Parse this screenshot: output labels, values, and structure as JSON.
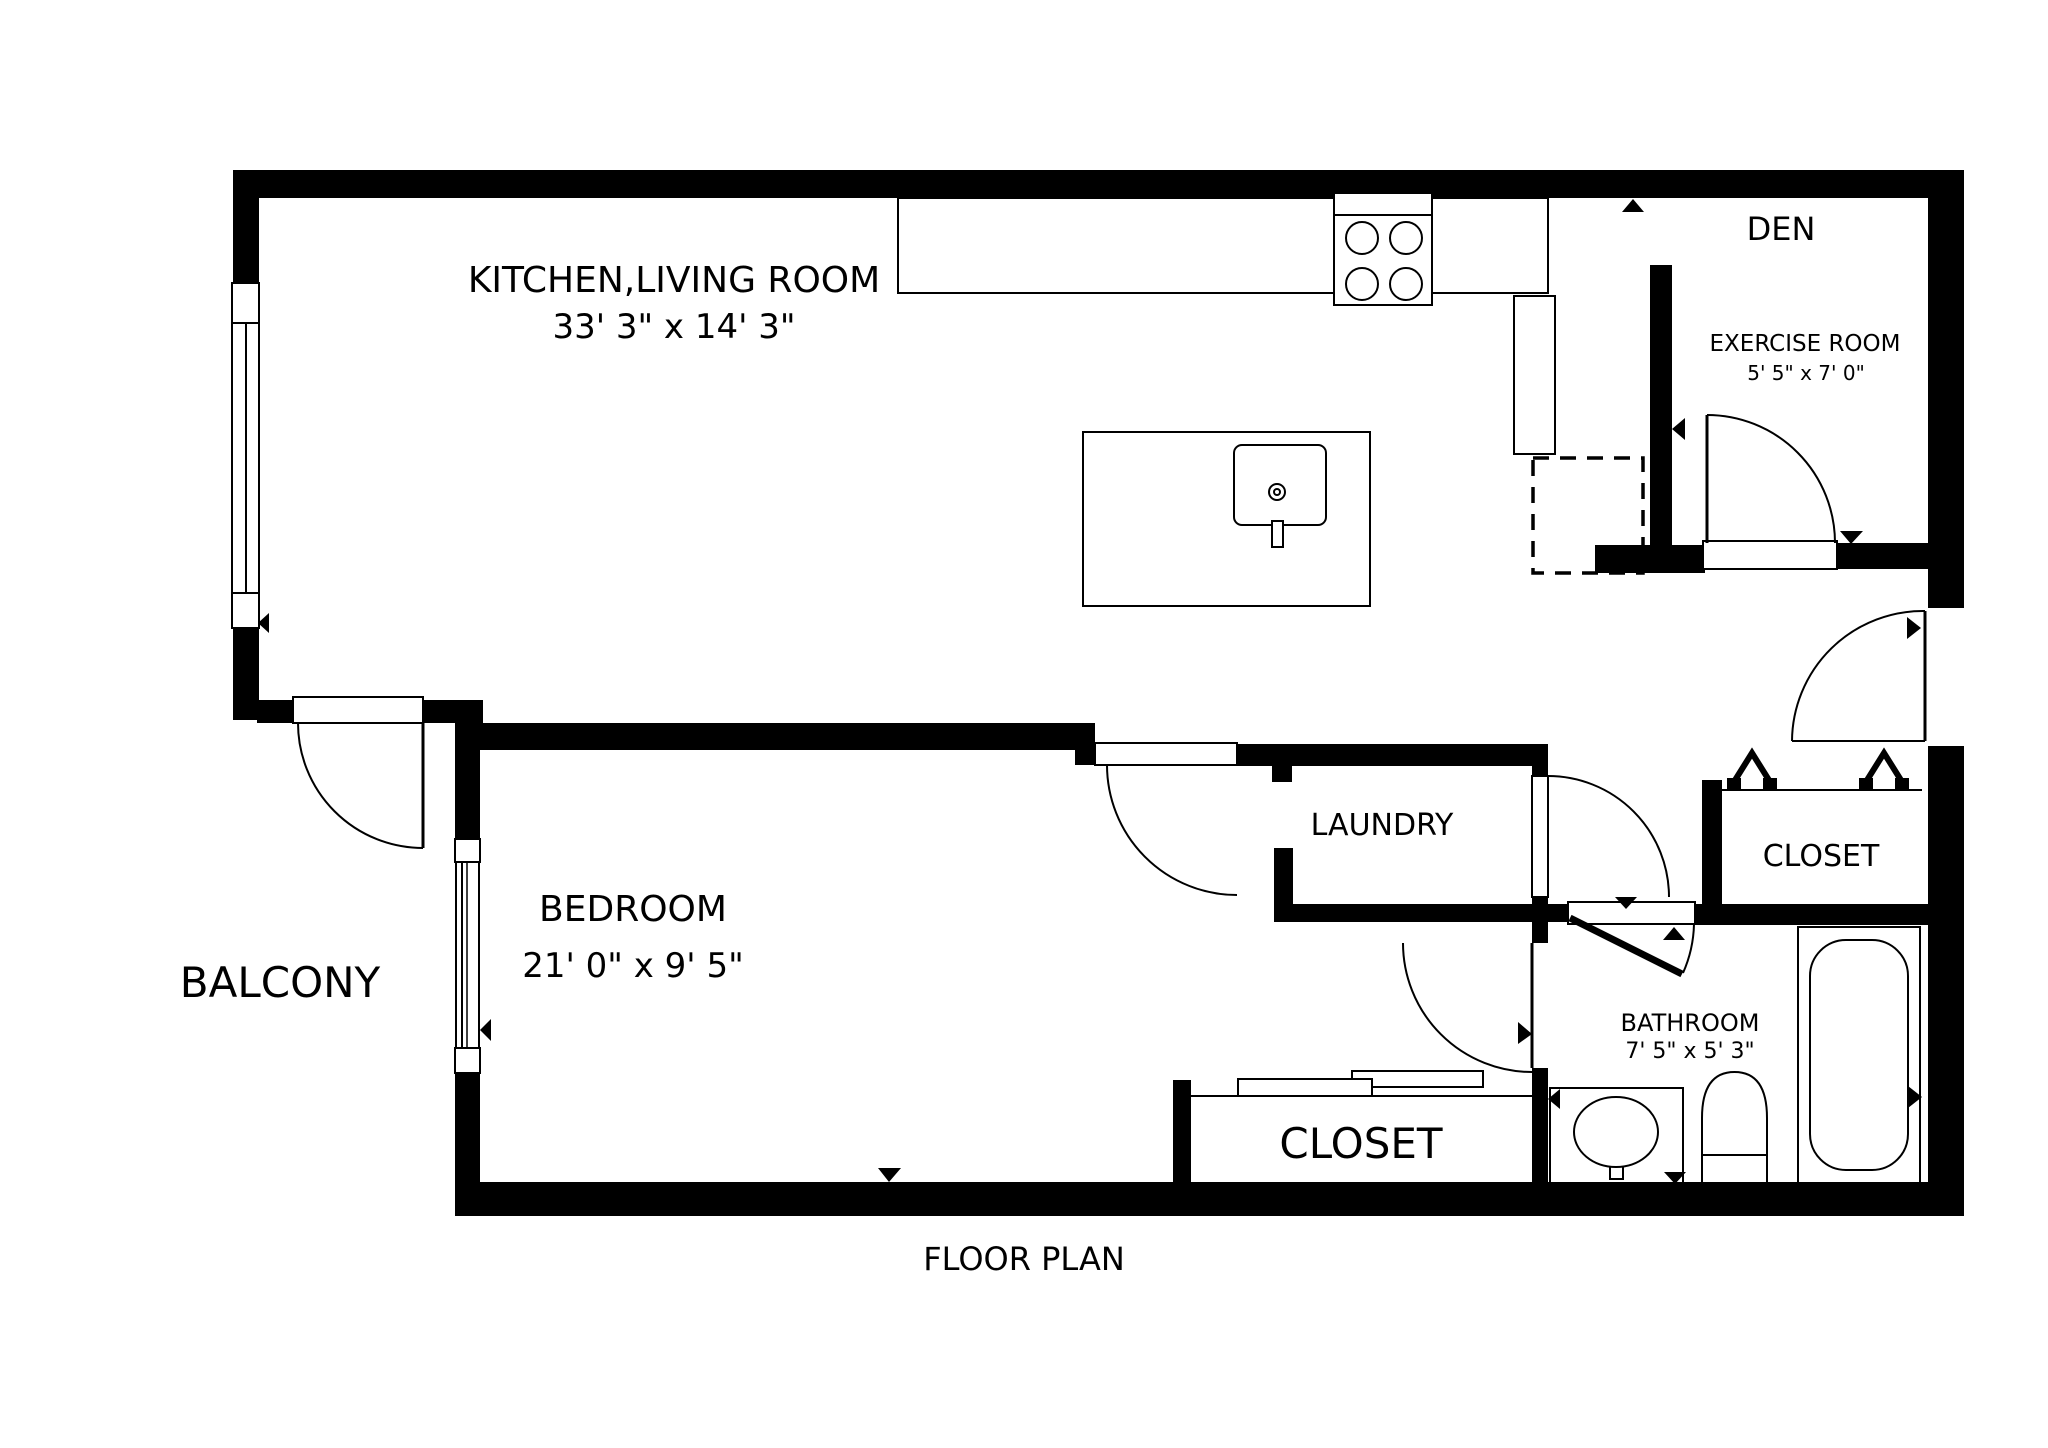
{
  "canvas": {
    "w": 2048,
    "h": 1448,
    "bg": "#ffffff",
    "ink": "#000000"
  },
  "caption": {
    "text": "FLOOR PLAN",
    "x": 1024,
    "y": 1270,
    "size": 32
  },
  "rooms": [
    {
      "id": "kitchen-living",
      "label": "KITCHEN,LIVING ROOM",
      "dims": "33' 3\" x 14' 3\"",
      "lx": 674,
      "ly": 292,
      "ls": 36,
      "dx": 674,
      "dy": 338,
      "ds": 34
    },
    {
      "id": "den",
      "label": "DEN",
      "dims": "",
      "lx": 1781,
      "ly": 240,
      "ls": 32
    },
    {
      "id": "exercise-room",
      "label": "EXERCISE ROOM",
      "dims": "5' 5\" x 7' 0\"",
      "lx": 1805,
      "ly": 351,
      "ls": 23,
      "dx": 1806,
      "dy": 380,
      "ds": 20
    },
    {
      "id": "laundry",
      "label": "LAUNDRY",
      "dims": "",
      "lx": 1382,
      "ly": 835,
      "ls": 30
    },
    {
      "id": "closet-hall",
      "label": "CLOSET",
      "dims": "",
      "lx": 1821,
      "ly": 866,
      "ls": 30
    },
    {
      "id": "bathroom",
      "label": "BATHROOM",
      "dims": "7' 5\" x 5' 3\"",
      "lx": 1690,
      "ly": 1031,
      "ls": 24,
      "dx": 1690,
      "dy": 1058,
      "ds": 22
    },
    {
      "id": "balcony",
      "label": "BALCONY",
      "dims": "",
      "lx": 280,
      "ly": 997,
      "ls": 42
    },
    {
      "id": "bedroom",
      "label": "BEDROOM",
      "dims": "21' 0\" x 9' 5\"",
      "lx": 633,
      "ly": 921,
      "ls": 36,
      "dx": 633,
      "dy": 977,
      "ds": 34
    },
    {
      "id": "closet-bedroom",
      "label": "CLOSET",
      "dims": "",
      "lx": 1361,
      "ly": 1158,
      "ls": 42
    }
  ],
  "walls": [
    [
      "top-wall",
      235,
      170,
      1729,
      28
    ],
    [
      "left-wall-upper",
      233,
      170,
      26,
      113
    ],
    [
      "left-wall-lower",
      233,
      628,
      26,
      92
    ],
    [
      "midwall-west",
      257,
      700,
      36,
      23
    ],
    [
      "midwall-balcony-east",
      423,
      700,
      60,
      23
    ],
    [
      "bedroom-top-wall",
      455,
      723,
      640,
      27
    ],
    [
      "bedroom-left-wall-upper",
      455,
      723,
      25,
      116
    ],
    [
      "bedroom-left-wall-lower",
      455,
      1073,
      25,
      109
    ],
    [
      "bedroom-door-jamb",
      1075,
      723,
      20,
      42
    ],
    [
      "laundry-top-wall",
      1237,
      744,
      311,
      22
    ],
    [
      "laundry-left-stub",
      1272,
      766,
      20,
      16
    ],
    [
      "laundry-left-wall-lower",
      1274,
      848,
      19,
      74
    ],
    [
      "laundry-bottom-wall",
      1274,
      904,
      296,
      18
    ],
    [
      "laundry-right-wall-top",
      1532,
      766,
      16,
      10
    ],
    [
      "hall-west-wall-upper",
      1532,
      897,
      16,
      46
    ],
    [
      "hall-west-wall-lower",
      1532,
      1068,
      16,
      114
    ],
    [
      "bathroom-top-wall",
      1695,
      904,
      233,
      21
    ],
    [
      "closet-hall-left-wall",
      1702,
      780,
      20,
      128
    ],
    [
      "den-left-wall",
      1650,
      265,
      22,
      280
    ],
    [
      "den-hall-wall",
      1595,
      545,
      110,
      28
    ],
    [
      "exercise-bottom-wall-right",
      1837,
      543,
      127,
      26
    ],
    [
      "right-wall-upper",
      1928,
      170,
      36,
      442
    ],
    [
      "right-wall-lower",
      1928,
      742,
      36,
      474
    ],
    [
      "bottom-wall",
      455,
      1182,
      1509,
      34
    ],
    [
      "closet-bedroom-left-wall",
      1173,
      1080,
      18,
      102
    ]
  ],
  "cuts": [
    [
      "entry-door-cut",
      1928,
      608,
      36,
      138
    ],
    [
      "lr-window-cut",
      233,
      283,
      26,
      345
    ],
    [
      "br-window-cut",
      455,
      839,
      25,
      234
    ]
  ],
  "openings": [
    [
      "balcony-door-opening",
      293,
      697,
      130,
      26
    ],
    [
      "bedroom-door-opening",
      1095,
      743,
      142,
      22
    ],
    [
      "exercise-door-opening",
      1703,
      541,
      134,
      28
    ],
    [
      "bathroom-door-opening",
      1568,
      902,
      127,
      22
    ],
    [
      "laundry-door-panel",
      1532,
      776,
      16,
      121
    ]
  ],
  "window_parts": [
    [
      "lr-window-cap-top",
      232,
      283,
      27,
      40
    ],
    [
      "lr-window-glass",
      232,
      323,
      27,
      270
    ],
    [
      "lr-window-cap-bottom",
      232,
      593,
      27,
      35
    ],
    [
      "br-window-cap-top",
      455,
      839,
      25,
      23
    ],
    [
      "br-window-glass",
      456,
      862,
      23,
      186
    ],
    [
      "br-window-cap-bottom",
      455,
      1048,
      25,
      25
    ]
  ],
  "fixtures": [
    [
      "kitchen-counter",
      898,
      198,
      650,
      95,
      0
    ],
    [
      "stove",
      1334,
      193,
      98,
      112,
      0
    ],
    [
      "counter-return",
      1514,
      296,
      41,
      158,
      0
    ],
    [
      "kitchen-island",
      1083,
      432,
      287,
      174,
      0
    ],
    [
      "island-sink",
      1234,
      445,
      92,
      80,
      8
    ],
    [
      "island-sink-stem",
      1272,
      521,
      11,
      26,
      0
    ],
    [
      "tub-surround",
      1798,
      927,
      122,
      256,
      0
    ],
    [
      "tub-inner",
      1810,
      940,
      98,
      230,
      36
    ],
    [
      "bath-sink-counter",
      1550,
      1088,
      133,
      95,
      0
    ],
    [
      "bath-sink-stem",
      1610,
      1153,
      13,
      26,
      0
    ],
    [
      "slide-door-upper",
      1352,
      1071,
      131,
      16,
      0
    ],
    [
      "slide-door-lower",
      1238,
      1079,
      134,
      17,
      0
    ]
  ],
  "dashed_rects": [
    [
      "dishwasher",
      1533,
      458,
      110,
      115
    ]
  ],
  "lines": [
    [
      "stove-divider",
      1334,
      215,
      1432,
      215,
      2
    ],
    [
      "closet-bedroom-top-line",
      1191,
      1096,
      1532,
      1096,
      2
    ],
    [
      "closet-hall-track",
      1720,
      790,
      1922,
      790,
      2
    ],
    [
      "entry-landing",
      1792,
      741,
      1925,
      741,
      2
    ],
    [
      "entry-door-panel",
      1925,
      611,
      1925,
      741,
      3
    ],
    [
      "lr-window-line",
      246,
      323,
      246,
      593,
      2
    ],
    [
      "br-window-line-a",
      462,
      862,
      462,
      1048,
      2
    ],
    [
      "br-window-line-b",
      467,
      862,
      467,
      1048,
      1.5
    ],
    [
      "toilet-seat-line",
      1702,
      1155,
      1767,
      1155,
      2
    ],
    [
      "bathroom-door-leaf",
      1570,
      918,
      1682,
      974,
      7
    ],
    [
      "balcony-door-panel",
      423,
      723,
      423,
      848,
      3
    ],
    [
      "exercise-door-panel",
      1707,
      415,
      1707,
      543,
      3
    ],
    [
      "bedroom-hall-door-panel",
      1532,
      943,
      1532,
      1068,
      3
    ]
  ],
  "arcs": [
    [
      "balcony-door-arc",
      "M298,723 A125,125 0 0 0 423,848"
    ],
    [
      "bedroom-door-arc",
      "M1107,765 A130,130 0 0 0 1237,895"
    ],
    [
      "laundry-door-arc",
      "M1548,776 A121,121 0 0 1 1669,897"
    ],
    [
      "bedroom-hall-door-arc",
      "M1403,943 A129,129 0 0 0 1532,1072"
    ],
    [
      "exercise-door-arc",
      "M1707,415 A128,128 0 0 1 1835,543"
    ],
    [
      "entry-door-arc",
      "M1792,741 A131,131 0 0 1 1925,611"
    ],
    [
      "bathroom-door-arc",
      "M1694,924 A127,127 0 0 1 1683,973"
    ]
  ],
  "chevrons": [
    [
      "closet-bifold-left",
      "M1732,785 L1752,753 L1772,785"
    ],
    [
      "closet-bifold-right",
      "M1864,785 L1884,753 L1904,785"
    ]
  ],
  "chevron_feet": [
    [
      1727,
      778,
      14,
      13
    ],
    [
      1763,
      778,
      14,
      13
    ],
    [
      1859,
      778,
      14,
      13
    ],
    [
      1895,
      778,
      14,
      13
    ]
  ],
  "toilet_path": "M1702,1183 L1702,1118 Q1702,1072 1734.5,1072 Q1767,1072 1767,1118 L1767,1183 Z",
  "circles": [
    [
      "stove-burner-1",
      1362,
      238,
      16
    ],
    [
      "stove-burner-2",
      1406,
      238,
      16
    ],
    [
      "stove-burner-3",
      1362,
      284,
      16
    ],
    [
      "stove-burner-4",
      1406,
      284,
      16
    ],
    [
      "island-faucet-outer",
      1277,
      492,
      8
    ],
    [
      "island-faucet-inner",
      1277,
      492,
      3
    ],
    [
      "bath-faucet-outer",
      1613,
      1131,
      9
    ],
    [
      "bath-faucet-inner",
      1613,
      1131,
      4
    ]
  ],
  "ellipses": [
    [
      "bath-sink-bowl",
      1616,
      1132,
      42,
      35
    ]
  ],
  "triangles": [
    [
      "marker-den-opening",
      [
        1622,
        212,
        1644,
        212,
        1633,
        199
      ]
    ],
    [
      "marker-exercise-west",
      [
        1685,
        418,
        1685,
        440,
        1672,
        429
      ]
    ],
    [
      "marker-exercise-door",
      [
        1840,
        531,
        1863,
        531,
        1851,
        544
      ]
    ],
    [
      "marker-entry-door",
      [
        1907,
        617,
        1907,
        639,
        1921,
        628
      ]
    ],
    [
      "marker-bedroom-top",
      [
        876,
        736,
        899,
        736,
        887,
        723
      ]
    ],
    [
      "marker-bedroom-window",
      [
        491,
        1019,
        491,
        1041,
        480,
        1030
      ]
    ],
    [
      "marker-bedroom-bottom",
      [
        878,
        1168,
        901,
        1168,
        889,
        1182
      ]
    ],
    [
      "marker-bedroom-hall-door",
      [
        1518,
        1022,
        1518,
        1044,
        1532,
        1034
      ]
    ],
    [
      "marker-laundry-door",
      [
        1615,
        897,
        1637,
        897,
        1626,
        909
      ]
    ],
    [
      "marker-bathroom-door",
      [
        1663,
        940,
        1685,
        940,
        1674,
        927
      ]
    ],
    [
      "marker-bath-sink-left",
      [
        1560,
        1089,
        1560,
        1109,
        1548,
        1099
      ]
    ],
    [
      "marker-bath-sink-down",
      [
        1664,
        1172,
        1686,
        1172,
        1675,
        1184
      ]
    ],
    [
      "marker-tub",
      [
        1908,
        1086,
        1908,
        1108,
        1922,
        1097
      ]
    ],
    [
      "marker-lr-window",
      [
        269,
        613,
        269,
        633,
        258,
        623
      ]
    ],
    [
      "marker-exercise-east",
      [
        1928,
        418,
        1928,
        440,
        1941,
        429
      ]
    ]
  ]
}
